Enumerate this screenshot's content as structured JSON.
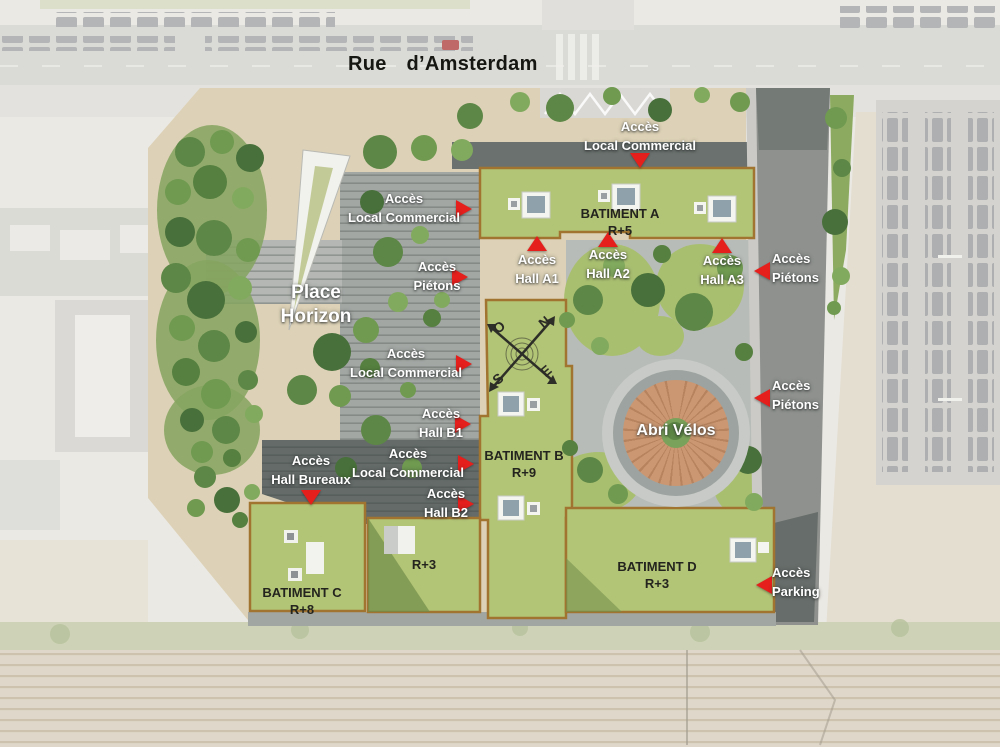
{
  "map": {
    "street_label": "Rue d’Amsterdam",
    "place": {
      "line1": "Place",
      "line2": "Horizon"
    },
    "bike_shelter_label": "Abri Vélos",
    "compass": {
      "n": "N",
      "s": "S",
      "e": "E",
      "o": "O"
    },
    "buildings": {
      "a": {
        "name": "BATIMENT A",
        "floors": "R+5"
      },
      "b": {
        "name": "BATIMENT B",
        "floors": "R+9"
      },
      "c": {
        "name": "BATIMENT C",
        "floors": "R+8"
      },
      "annex": {
        "floors": "R+3"
      },
      "d": {
        "name": "BATIMENT D",
        "floors": "R+3"
      }
    },
    "access": {
      "top_local_commercial": {
        "line1": "Accès",
        "line2": "Local Commercial"
      },
      "left_local_commercial": {
        "line1": "Accès",
        "line2": "Local Commercial"
      },
      "left_pietons": {
        "line1": "Accès",
        "line2": "Piétons"
      },
      "hall_a1": {
        "line1": "Accès",
        "line2": "Hall A1"
      },
      "hall_a2": {
        "line1": "Accès",
        "line2": "Hall A2"
      },
      "hall_a3": {
        "line1": "Accès",
        "line2": "Hall A3"
      },
      "right_pietons_1": {
        "line1": "Accès",
        "line2": "Piétons"
      },
      "right_pietons_2": {
        "line1": "Accès",
        "line2": "Piétons"
      },
      "mid_local_commercial": {
        "line1": "Accès",
        "line2": "Local Commercial"
      },
      "hall_b1": {
        "line1": "Accès",
        "line2": "Hall B1"
      },
      "hall_bureaux": {
        "line1": "Accès",
        "line2": "Hall Bureaux"
      },
      "low_local_commercial": {
        "line1": "Accès",
        "line2": "Local Commercial"
      },
      "hall_b2": {
        "line1": "Accès",
        "line2": "Hall B2"
      },
      "parking": {
        "line1": "Accès",
        "line2": "Parking"
      }
    },
    "colors": {
      "accent_red": "#e41f1c",
      "roof_lawn_green": "#b2c476",
      "tree_green": "#5d8746",
      "site_ground_beige": "#ddd2b7",
      "plot_outline_brown": "#a1742f",
      "road_gray": "#8e918e",
      "dark_paving_gray": "#646b69",
      "shelter_wood": "#cb9772",
      "label_white": "#ffffff",
      "building_text": "#24241e"
    }
  }
}
